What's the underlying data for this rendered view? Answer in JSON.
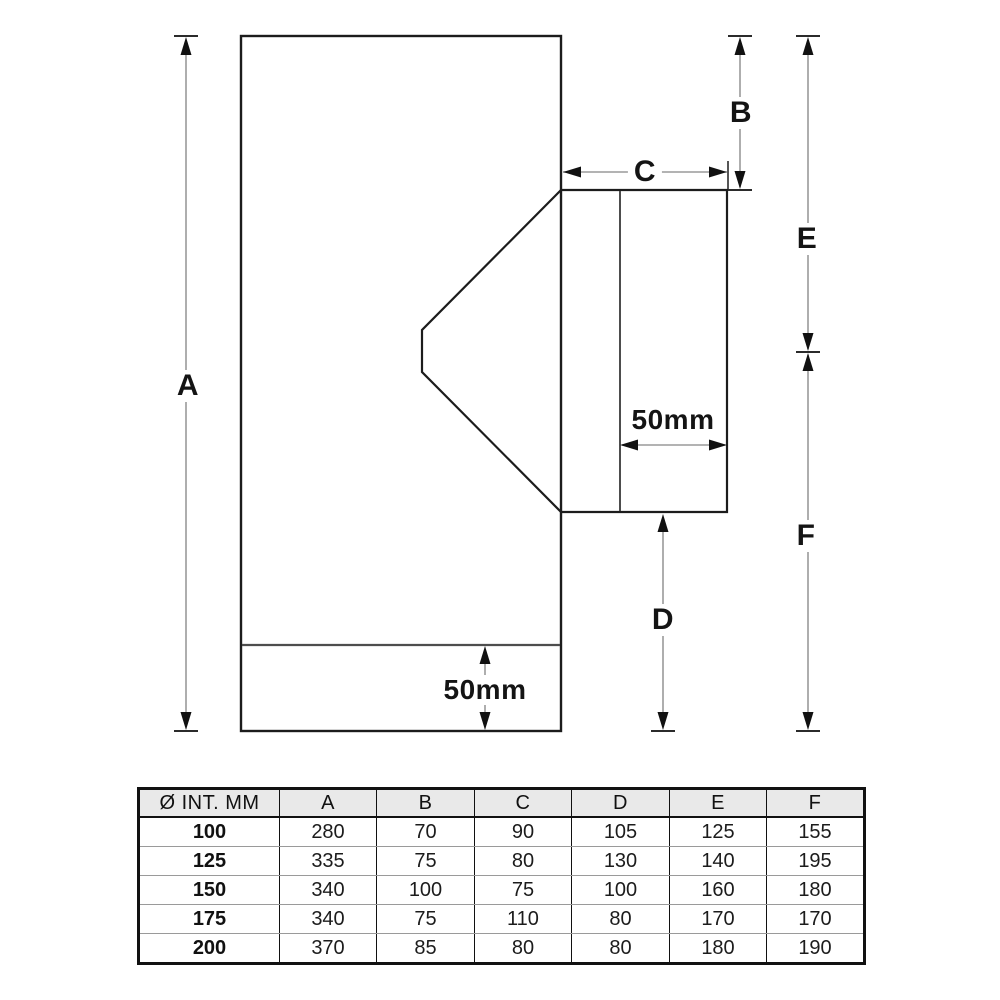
{
  "diagram": {
    "labels": {
      "a": "A",
      "b": "B",
      "c": "C",
      "d": "D",
      "e": "E",
      "f": "F"
    },
    "branch_width_label": "50mm",
    "base_section_label": "50mm",
    "colors": {
      "outline": "#1c1c1c",
      "secondary_line": "#4d4d4d",
      "dimension_line": "#9a9a9a",
      "arrowhead": "#111111",
      "table_header_bg": "#e9e9e9"
    }
  },
  "table": {
    "headers": [
      "Ø INT. MM",
      "A",
      "B",
      "C",
      "D",
      "E",
      "F"
    ],
    "rows": [
      {
        "size": "100",
        "values": [
          "280",
          "70",
          "90",
          "105",
          "125",
          "155"
        ]
      },
      {
        "size": "125",
        "values": [
          "335",
          "75",
          "80",
          "130",
          "140",
          "195"
        ]
      },
      {
        "size": "150",
        "values": [
          "340",
          "100",
          "75",
          "100",
          "160",
          "180"
        ]
      },
      {
        "size": "175",
        "values": [
          "340",
          "75",
          "110",
          "80",
          "170",
          "170"
        ]
      },
      {
        "size": "200",
        "values": [
          "370",
          "85",
          "80",
          "80",
          "180",
          "190"
        ]
      }
    ]
  }
}
